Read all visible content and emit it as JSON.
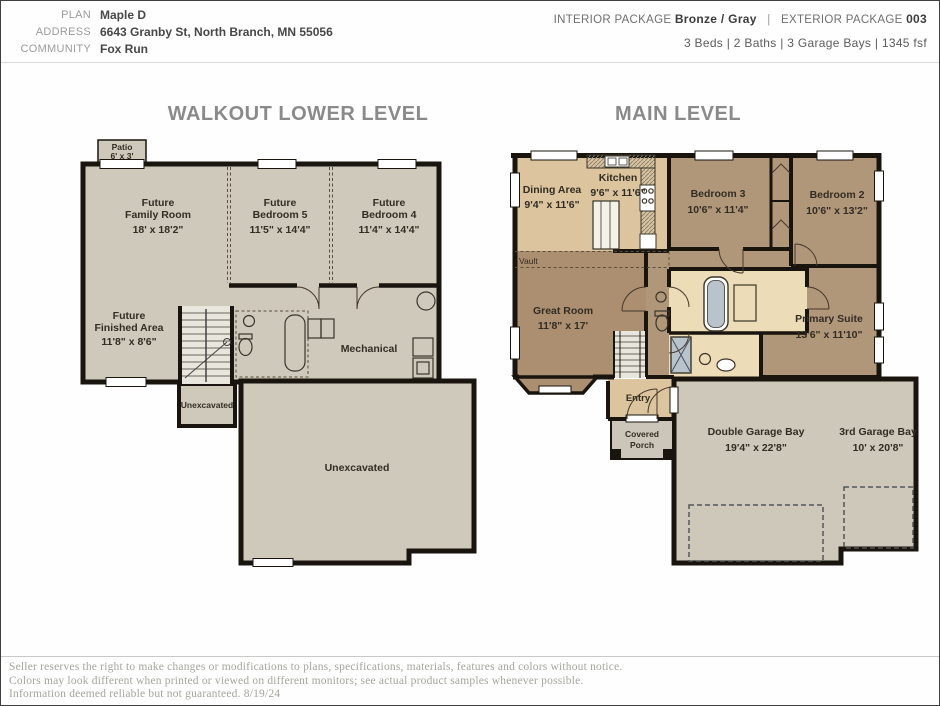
{
  "header": {
    "plan_label": "PLAN",
    "plan_value": "Maple D",
    "address_label": "ADDRESS",
    "address_value": "6643 Granby St, North Branch, MN 55056",
    "community_label": "COMMUNITY",
    "community_value": "Fox Run",
    "interior_package_label": "INTERIOR PACKAGE",
    "interior_package_value": "Bronze / Gray",
    "divider": "|",
    "exterior_package_label": "EXTERIOR PACKAGE",
    "exterior_package_value": "003",
    "specs": "3 Beds  |  2 Baths  |  3 Garage Bays  |  1345  fsf"
  },
  "lower_level": {
    "title": "WALKOUT LOWER LEVEL",
    "rooms": {
      "patio": {
        "name": "Patio",
        "dims": "6' x 3'"
      },
      "family_room": {
        "prefix": "Future",
        "name": "Family Room",
        "dims": "18' x 18'2\""
      },
      "bedroom5": {
        "prefix": "Future",
        "name": "Bedroom 5",
        "dims": "11'5\" x 14'4\""
      },
      "bedroom4": {
        "prefix": "Future",
        "name": "Bedroom 4",
        "dims": "11'4\" x 14'4\""
      },
      "finished_area": {
        "prefix": "Future",
        "name": "Finished Area",
        "dims": "11'8\" x 8'6\""
      },
      "mechanical": {
        "name": "Mechanical"
      },
      "unexcavated_small": {
        "name": "Unexcavated"
      },
      "unexcavated_large": {
        "name": "Unexcavated"
      }
    }
  },
  "main_level": {
    "title": "MAIN LEVEL",
    "rooms": {
      "dining": {
        "name": "Dining Area",
        "dims": "9'4\" x 11'6\""
      },
      "kitchen": {
        "name": "Kitchen",
        "dims": "9'6\" x 11'6\""
      },
      "bedroom3": {
        "name": "Bedroom 3",
        "dims": "10'6\" x 11'4\""
      },
      "bedroom2": {
        "name": "Bedroom 2",
        "dims": "10'6\" x 13'2\""
      },
      "vault": {
        "name": "Vault"
      },
      "great_room": {
        "name": "Great Room",
        "dims": "11'8\" x 17'"
      },
      "primary_suite": {
        "name": "Primary Suite",
        "dims": "13'6\" x 11'10\""
      },
      "entry": {
        "name": "Entry"
      },
      "covered_porch": {
        "line1": "Covered",
        "line2": "Porch"
      },
      "double_garage": {
        "name": "Double Garage Bay",
        "dims": "19'4\" x 22'8\""
      },
      "third_garage": {
        "name": "3rd Garage Bay",
        "dims": "10' x 20'8\""
      }
    }
  },
  "footer": {
    "line1": "Seller reserves the right to make changes or modifications to plans, specifications, materials, features and colors without notice.",
    "line2": "Colors may look different when printed or viewed on different monitors; see actual product samples whenever possible.",
    "line3": "Information deemed reliable but not guaranteed.  8/19/24"
  },
  "colors": {
    "wall": "#19150e",
    "lower_room_gray": "#cfc9bc",
    "tan": "#dcc59e",
    "brown": "#b1977a",
    "brown_dark": "#ab8f70",
    "bath_cream": "#eddcb8",
    "garage_gray": "#cdc8ba",
    "porch_gray": "#cbc6b9",
    "title_gray": "#8a8a8a"
  }
}
